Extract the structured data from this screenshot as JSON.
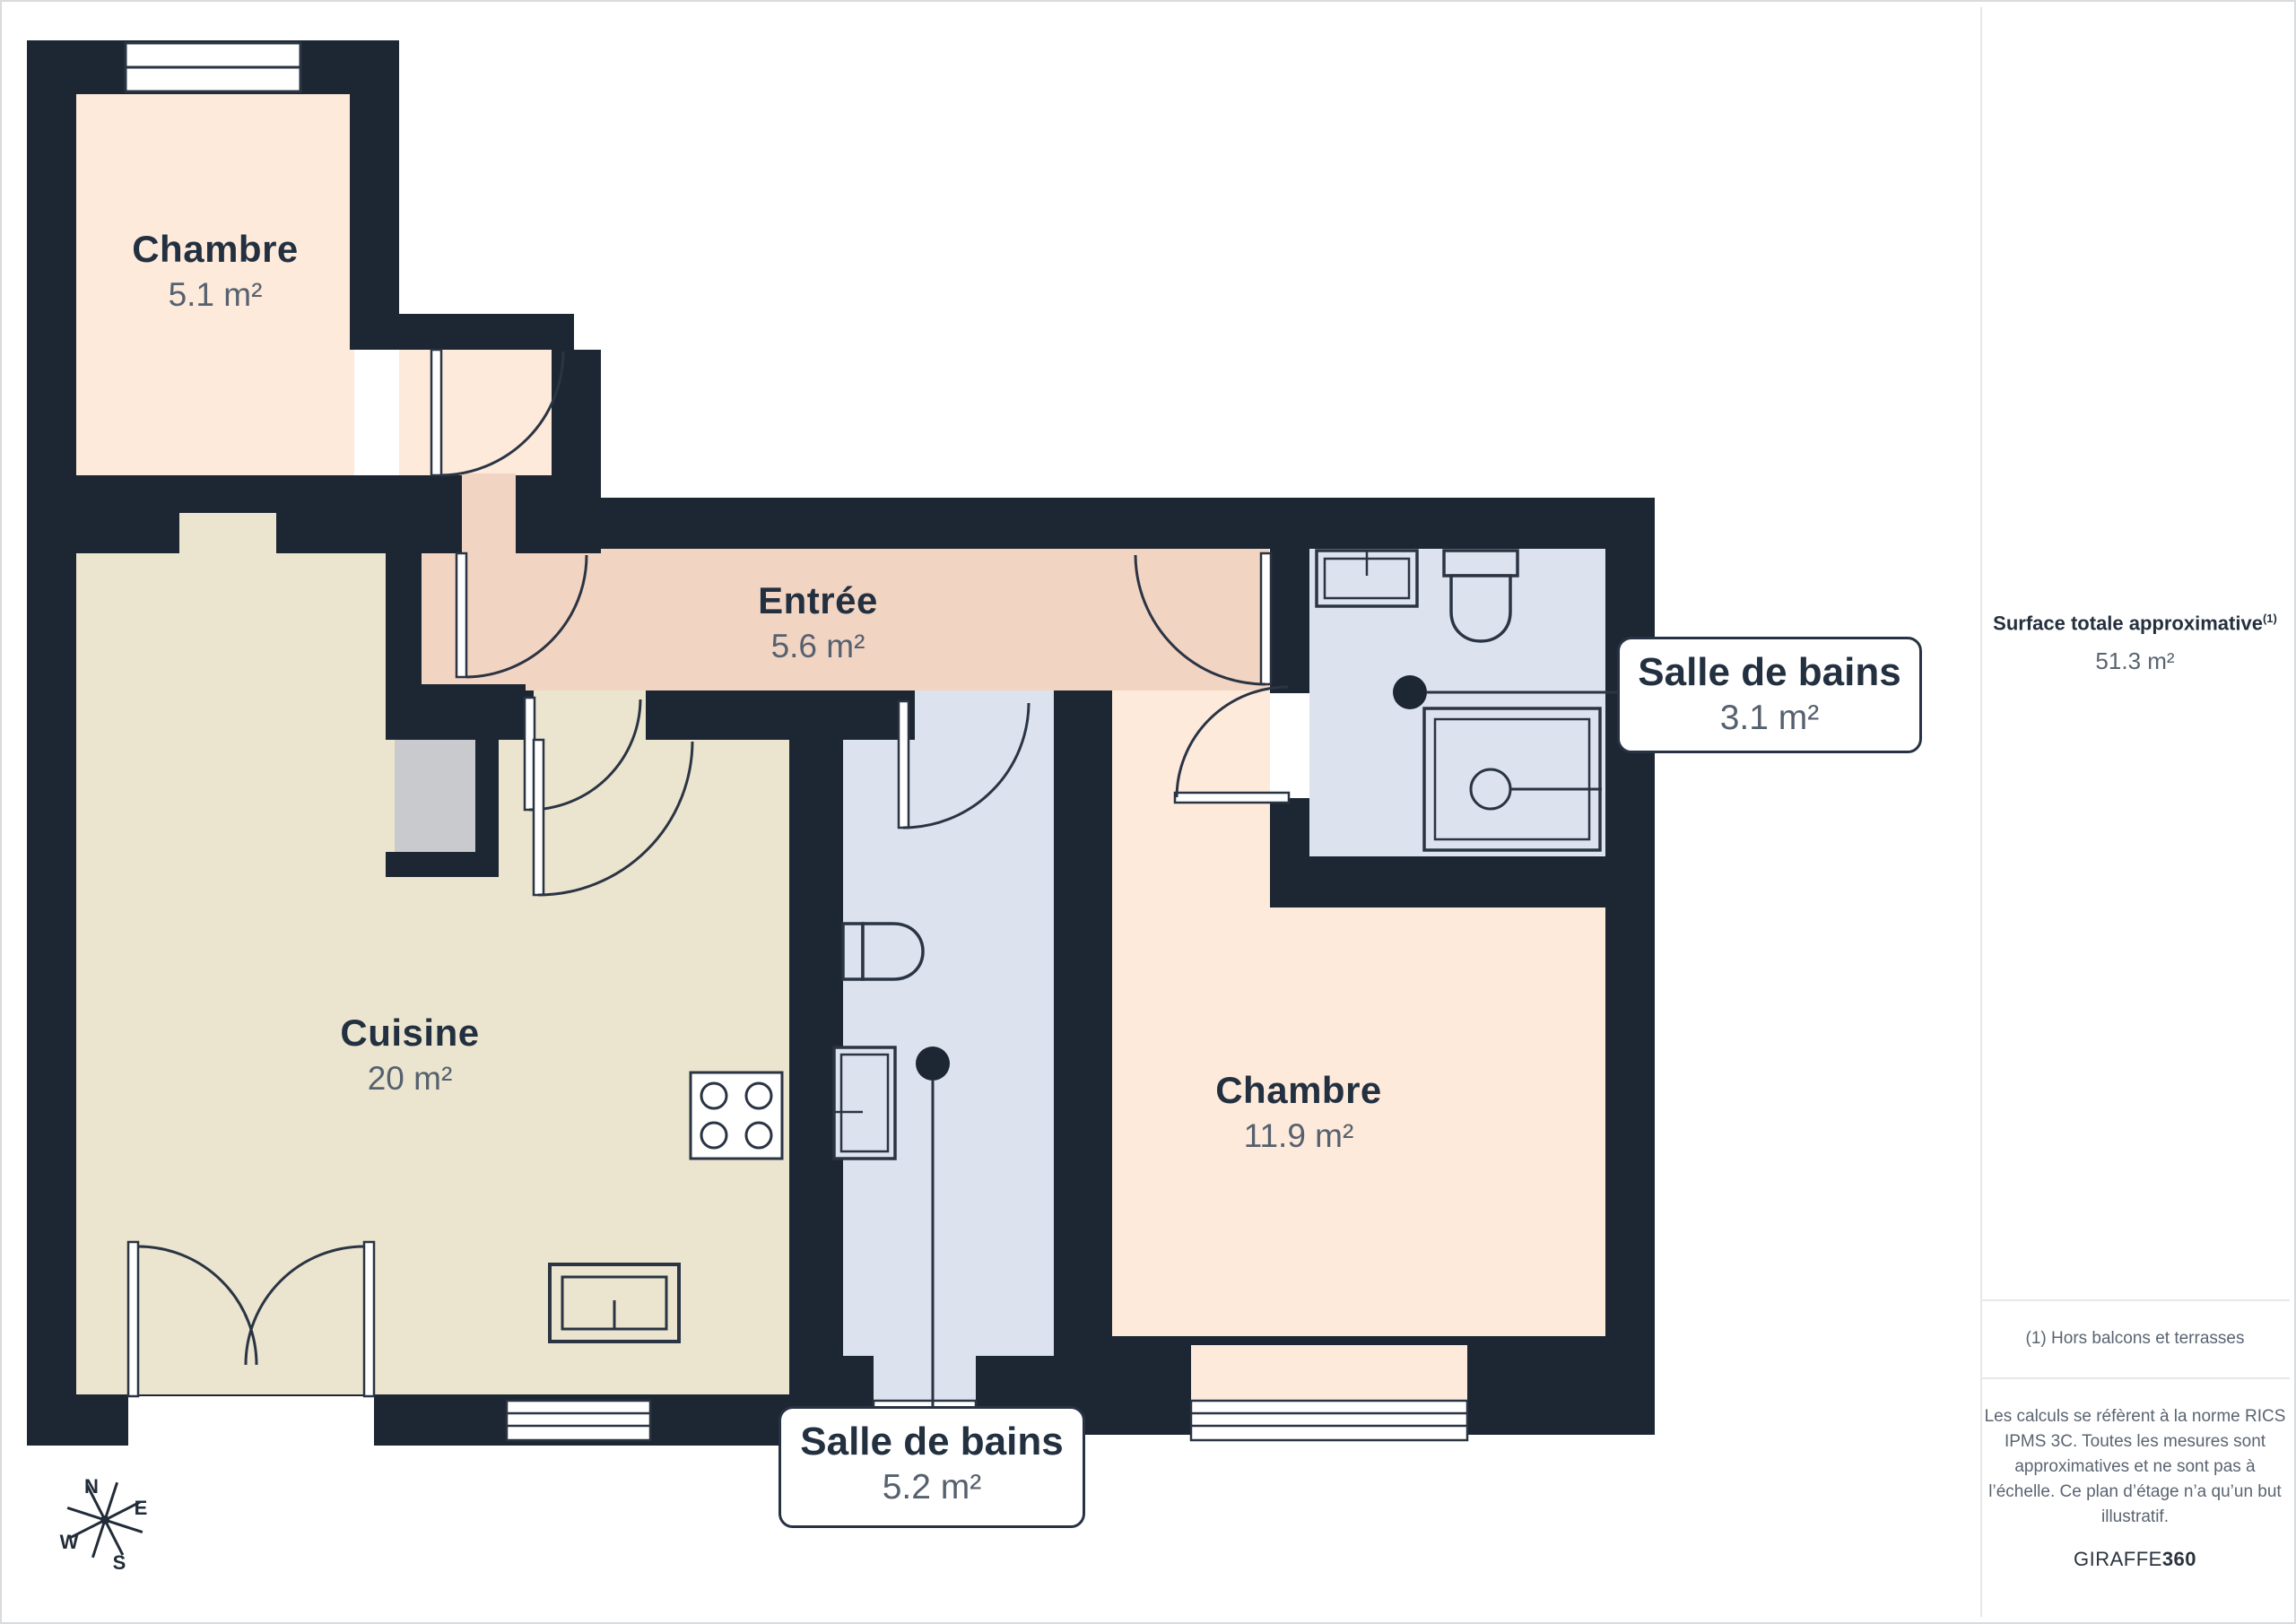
{
  "page": {
    "rooms": [
      {
        "name": "Chambre",
        "area": "5.1 m²"
      },
      {
        "name": "Entrée",
        "area": "5.6 m²"
      },
      {
        "name": "Cuisine",
        "area": "20 m²"
      },
      {
        "name": "Chambre",
        "area": "11.9 m²"
      }
    ],
    "callouts": [
      {
        "name": "Salle de bains",
        "area": "3.1 m²"
      },
      {
        "name": "Salle de bains",
        "area": "5.2 m²"
      }
    ],
    "compass": {
      "north": "N",
      "east": "E",
      "south": "S",
      "west": "W"
    },
    "sidebar": {
      "surface_label": "Surface totale approximative",
      "surface_sup": "(1)",
      "surface_value": "51.3 m²",
      "footnote": "(1) Hors balcons et terrasses",
      "disclaimer": "Les calculs se réfèrent à la norme RICS IPMS 3C. Toutes les mesures sont approximatives et ne sont pas à l’échelle. Ce plan d’étage n’a qu’un but illustratif.",
      "brand_name": "GIRAFFE",
      "brand_suffix": "360"
    },
    "colors": {
      "wall": "#1d2733",
      "bedroom_fill": "#fdeadb",
      "hall_fill": "#f2d4c3",
      "kitchen_fill": "#ebe5cf",
      "bathroom_fill": "#dce2ee",
      "closet_fill": "#c8cacd",
      "label_text": "#233040",
      "area_text": "#56616f"
    }
  }
}
